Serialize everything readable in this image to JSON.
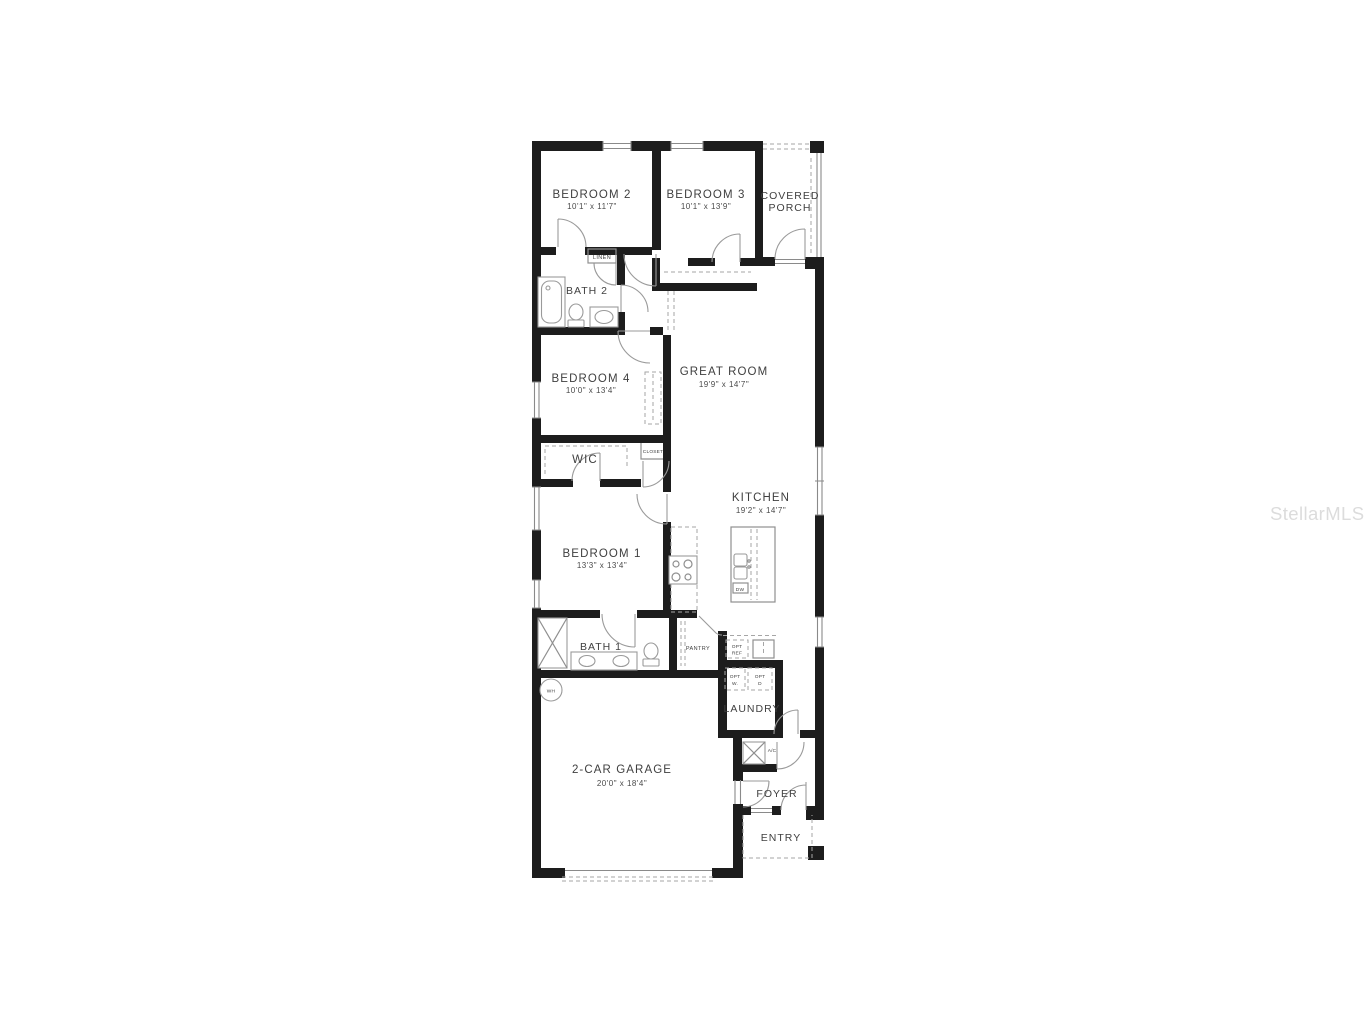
{
  "watermark": "StellarMLS",
  "rooms": {
    "bedroom2": {
      "name": "BEDROOM 2",
      "dims": "10'1\" x 11'7\""
    },
    "bedroom3": {
      "name": "BEDROOM 3",
      "dims": "10'1\" x 13'9\""
    },
    "porch": {
      "line1": "COVERED",
      "line2": "PORCH"
    },
    "linen": {
      "name": "LINEN"
    },
    "bath2": {
      "name": "BATH 2"
    },
    "bedroom4": {
      "name": "BEDROOM 4",
      "dims": "10'0\" x 13'4\""
    },
    "great_room": {
      "name": "GREAT ROOM",
      "dims": "19'9\" x 14'7\""
    },
    "wic": {
      "name": "WIC"
    },
    "closet": {
      "name": "CLOSET"
    },
    "kitchen": {
      "name": "KITCHEN",
      "dims": "19'2\" x 14'7\""
    },
    "bedroom1": {
      "name": "BEDROOM 1",
      "dims": "13'3\" x 13'4\""
    },
    "bath1": {
      "name": "BATH 1"
    },
    "pantry": {
      "name": "PANTRY"
    },
    "opt_ref": {
      "line1": "OPT",
      "line2": "REF"
    },
    "opt_w": {
      "line1": "OPT",
      "line2": "W."
    },
    "opt_d": {
      "line1": "OPT",
      "line2": "D"
    },
    "laundry": {
      "name": "LAUNDRY"
    },
    "ac": {
      "name": "A/C"
    },
    "wh": {
      "name": "WH"
    },
    "dw": {
      "name": "DW"
    },
    "garage": {
      "name": "2-CAR GARAGE",
      "dims": "20'0\" x 18'4\""
    },
    "foyer": {
      "name": "FOYER"
    },
    "entry": {
      "name": "ENTRY"
    }
  },
  "colors": {
    "wall": "#1d1d1d",
    "line": "#9a9a9a",
    "label": "#3f3f3f",
    "watermark": "#dcdcdc"
  }
}
